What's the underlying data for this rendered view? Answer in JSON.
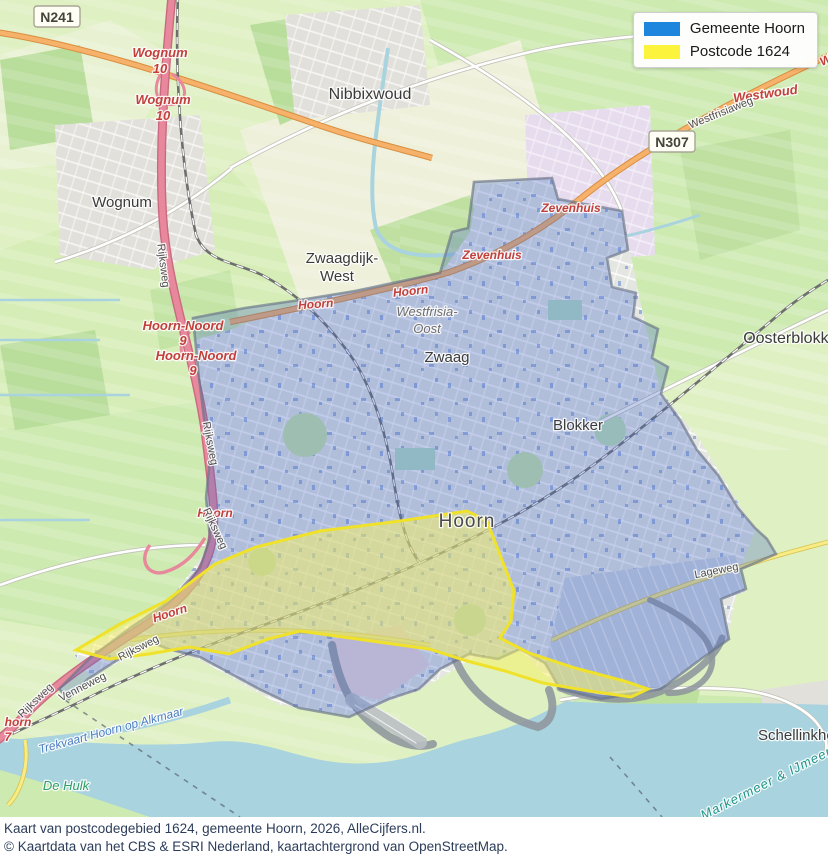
{
  "legend": {
    "items": [
      {
        "id": "gemeente-hoorn",
        "label": "Gemeente Hoorn",
        "color": "#1e87dd"
      },
      {
        "id": "postcode-1624",
        "label": "Postcode 1624",
        "color": "#fcf43c"
      }
    ]
  },
  "caption": {
    "line1": "Kaart van postcodegebied 1624, gemeente Hoorn, 2026, AlleCijfers.nl.",
    "line2": "© Kaartdata van het CBS & ESRI Nederland, kaartachtergrond van OpenStreetMap."
  },
  "map": {
    "overlay_colors": {
      "gemeente_fill": "rgba(70,105,200,0.32)",
      "gemeente_edge": "rgba(105,115,135,0.65)",
      "postcode_fill": "rgba(248,241,95,0.50)",
      "postcode_edge": "#f0e22a"
    },
    "shields": [
      {
        "id": "n241",
        "text": "N241",
        "x": 57,
        "y": 17
      },
      {
        "id": "n307",
        "text": "N307",
        "x": 672,
        "y": 142
      }
    ],
    "labels": [
      {
        "id": "wognum-town",
        "text": "Wognum",
        "x": 122,
        "y": 207,
        "cls": "town",
        "size": 15
      },
      {
        "id": "nibbixwoud",
        "text": "Nibbixwoud",
        "x": 370,
        "y": 99,
        "cls": "town",
        "size": 16
      },
      {
        "id": "zwaagdijk-west-1",
        "text": "Zwaagdijk-",
        "x": 342,
        "y": 263,
        "cls": "town",
        "size": 15
      },
      {
        "id": "zwaagdijk-west-2",
        "text": "West",
        "x": 337,
        "y": 281,
        "cls": "town",
        "size": 15
      },
      {
        "id": "zwaag",
        "text": "Zwaag",
        "x": 447,
        "y": 362,
        "cls": "town",
        "size": 15
      },
      {
        "id": "blokker",
        "text": "Blokker",
        "x": 578,
        "y": 430,
        "cls": "town",
        "size": 15
      },
      {
        "id": "oosterblokker",
        "text": "Oosterblokker",
        "x": 793,
        "y": 343,
        "cls": "town",
        "size": 16
      },
      {
        "id": "schellinkhout",
        "text": "Schellinkhout",
        "x": 758,
        "y": 740,
        "cls": "town",
        "size": 15,
        "anchor": "start"
      },
      {
        "id": "hoorn-city",
        "text": "Hoorn",
        "x": 467,
        "y": 527,
        "cls": "city",
        "size": 19
      },
      {
        "id": "westfrisia-1",
        "text": "Westfrisia-",
        "x": 427,
        "y": 316,
        "cls": "suburb",
        "size": 13
      },
      {
        "id": "westfrisia-2",
        "text": "Oost",
        "x": 427,
        "y": 333,
        "cls": "suburb",
        "size": 13
      },
      {
        "id": "exit-wognum-1a",
        "text": "Wognum",
        "x": 160,
        "y": 57,
        "cls": "junction",
        "size": 13
      },
      {
        "id": "exit-wognum-1b",
        "text": "10",
        "x": 160,
        "y": 73,
        "cls": "junction",
        "size": 13
      },
      {
        "id": "exit-wognum-2a",
        "text": "Wognum",
        "x": 163,
        "y": 104,
        "cls": "junction",
        "size": 13
      },
      {
        "id": "exit-wognum-2b",
        "text": "10",
        "x": 163,
        "y": 120,
        "cls": "junction",
        "size": 13
      },
      {
        "id": "exit-hoorn-noord-1a",
        "text": "Hoorn-Noord",
        "x": 183,
        "y": 330,
        "cls": "junction",
        "size": 13
      },
      {
        "id": "exit-hoorn-noord-1b",
        "text": "9",
        "x": 183,
        "y": 345,
        "cls": "junction",
        "size": 13
      },
      {
        "id": "exit-hoorn-noord-2a",
        "text": "Hoorn-Noord",
        "x": 196,
        "y": 360,
        "cls": "junction",
        "size": 13
      },
      {
        "id": "exit-hoorn-noord-2b",
        "text": "9",
        "x": 193,
        "y": 375,
        "cls": "junction",
        "size": 13
      },
      {
        "id": "zevenhuis-1",
        "text": "Zevenhuis",
        "x": 571,
        "y": 212,
        "cls": "junction",
        "size": 12
      },
      {
        "id": "zevenhuis-2",
        "text": "Zevenhuis",
        "x": 492,
        "y": 259,
        "cls": "junction",
        "size": 12
      },
      {
        "id": "hoorn-road-1",
        "text": "Hoorn",
        "x": 411,
        "y": 295,
        "cls": "junction",
        "size": 12,
        "rot": -6
      },
      {
        "id": "hoorn-road-2",
        "text": "Hoorn",
        "x": 316,
        "y": 308,
        "cls": "junction",
        "size": 12,
        "rot": -4
      },
      {
        "id": "exit-hoorn-3",
        "text": "Hoorn",
        "x": 215,
        "y": 517,
        "cls": "junction",
        "size": 12
      },
      {
        "id": "exit-hoorn-4",
        "text": "Hoorn",
        "x": 171,
        "y": 617,
        "cls": "junction",
        "size": 12,
        "rot": -18
      },
      {
        "id": "exit-avenhorn-a",
        "text": "horn",
        "x": 18,
        "y": 726,
        "cls": "junction",
        "size": 12
      },
      {
        "id": "exit-avenhorn-b",
        "text": "7",
        "x": 8,
        "y": 741,
        "cls": "junction",
        "size": 12
      },
      {
        "id": "westwoud",
        "text": "Westwoud",
        "x": 766,
        "y": 98,
        "cls": "junction",
        "size": 13,
        "rot": -8
      },
      {
        "id": "westwoud-clip",
        "text": "Westwoud",
        "x": 822,
        "y": 66,
        "cls": "junction",
        "size": 12,
        "rot": -24,
        "anchor": "start"
      },
      {
        "id": "rijksweg-1",
        "text": "Rijksweg",
        "x": 160,
        "y": 266,
        "cls": "road",
        "size": 11,
        "rot": 83
      },
      {
        "id": "rijksweg-2",
        "text": "Rijksweg",
        "x": 207,
        "y": 444,
        "cls": "road",
        "size": 11,
        "rot": 79
      },
      {
        "id": "rijksweg-3",
        "text": "Rijksweg",
        "x": 212,
        "y": 530,
        "cls": "road",
        "size": 11,
        "rot": 65
      },
      {
        "id": "rijksweg-4",
        "text": "Rijksweg",
        "x": 140,
        "y": 651,
        "cls": "road",
        "size": 11,
        "rot": -27
      },
      {
        "id": "rijksweg-5",
        "text": "Rijksweg",
        "x": 38,
        "y": 703,
        "cls": "road",
        "size": 11,
        "rot": -44
      },
      {
        "id": "venneweg",
        "text": "Venneweg",
        "x": 84,
        "y": 690,
        "cls": "road",
        "size": 11,
        "rot": -27
      },
      {
        "id": "westfrisiaweg",
        "text": "Westfrisiaweg",
        "x": 722,
        "y": 116,
        "cls": "road",
        "size": 11,
        "rot": -22
      },
      {
        "id": "lageweg",
        "text": "Lageweg",
        "x": 717,
        "y": 574,
        "cls": "road",
        "size": 11,
        "rot": -11
      },
      {
        "id": "trekvaart",
        "text": "Trekvaart Hoorn op Alkmaar",
        "x": 112,
        "y": 734,
        "cls": "water",
        "size": 12,
        "rot": -15
      },
      {
        "id": "markermeer",
        "text": "Markermeer & IJmeer",
        "x": 768,
        "y": 787,
        "cls": "sea",
        "size": 13,
        "rot": -27
      },
      {
        "id": "de-hulk",
        "text": "De Hulk",
        "x": 66,
        "y": 790,
        "cls": "hamlet",
        "size": 13
      }
    ]
  }
}
